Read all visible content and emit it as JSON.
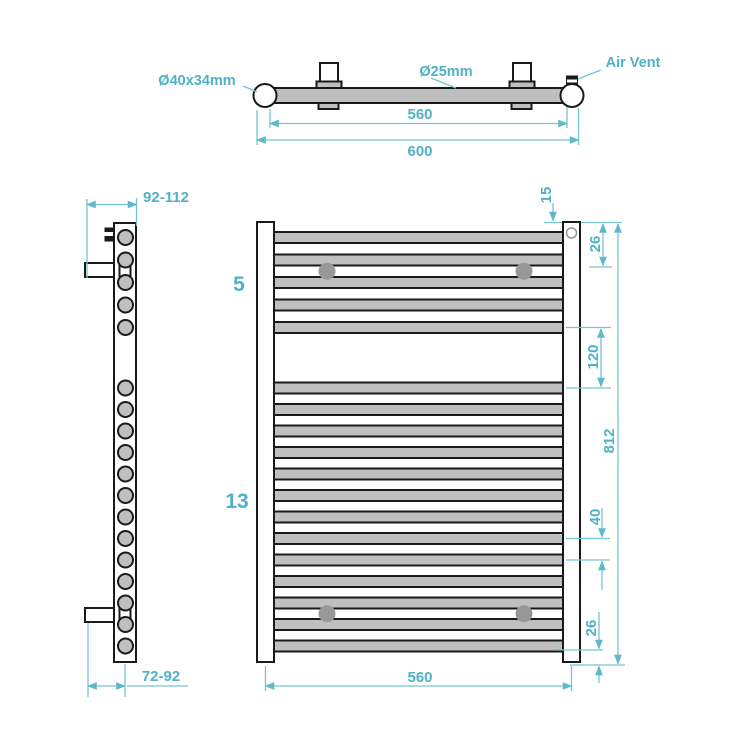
{
  "drawing": {
    "top_view": {
      "left_cap_label": "Ø40x34mm",
      "tube_diameter_label": "Ø25mm",
      "air_vent_label": "Air Vent",
      "dim_inner_width": "560",
      "dim_overall_width": "600"
    },
    "side_view": {
      "dim_top_projection": "92-112",
      "dim_bottom_projection": "72-92"
    },
    "front_view": {
      "top_bar_count": 5,
      "bottom_bar_count": 13,
      "top_bar_count_label": "5",
      "bottom_bar_count_label": "13",
      "dim_rail_top_offset": "15",
      "dim_top_bracket_offset": "26",
      "dim_middle_gap": "120",
      "dim_overall_height": "812",
      "dim_bar_pitch": "40",
      "dim_bottom_offset": "26",
      "dim_rail_centres_width": "560"
    },
    "colors": {
      "dimension_text": "#4fb2c6",
      "dimension_line": "#79c4d1",
      "outline": "#1a1a1a",
      "metal_fill": "#bfbfbf",
      "bracket_dot": "#989898"
    }
  }
}
